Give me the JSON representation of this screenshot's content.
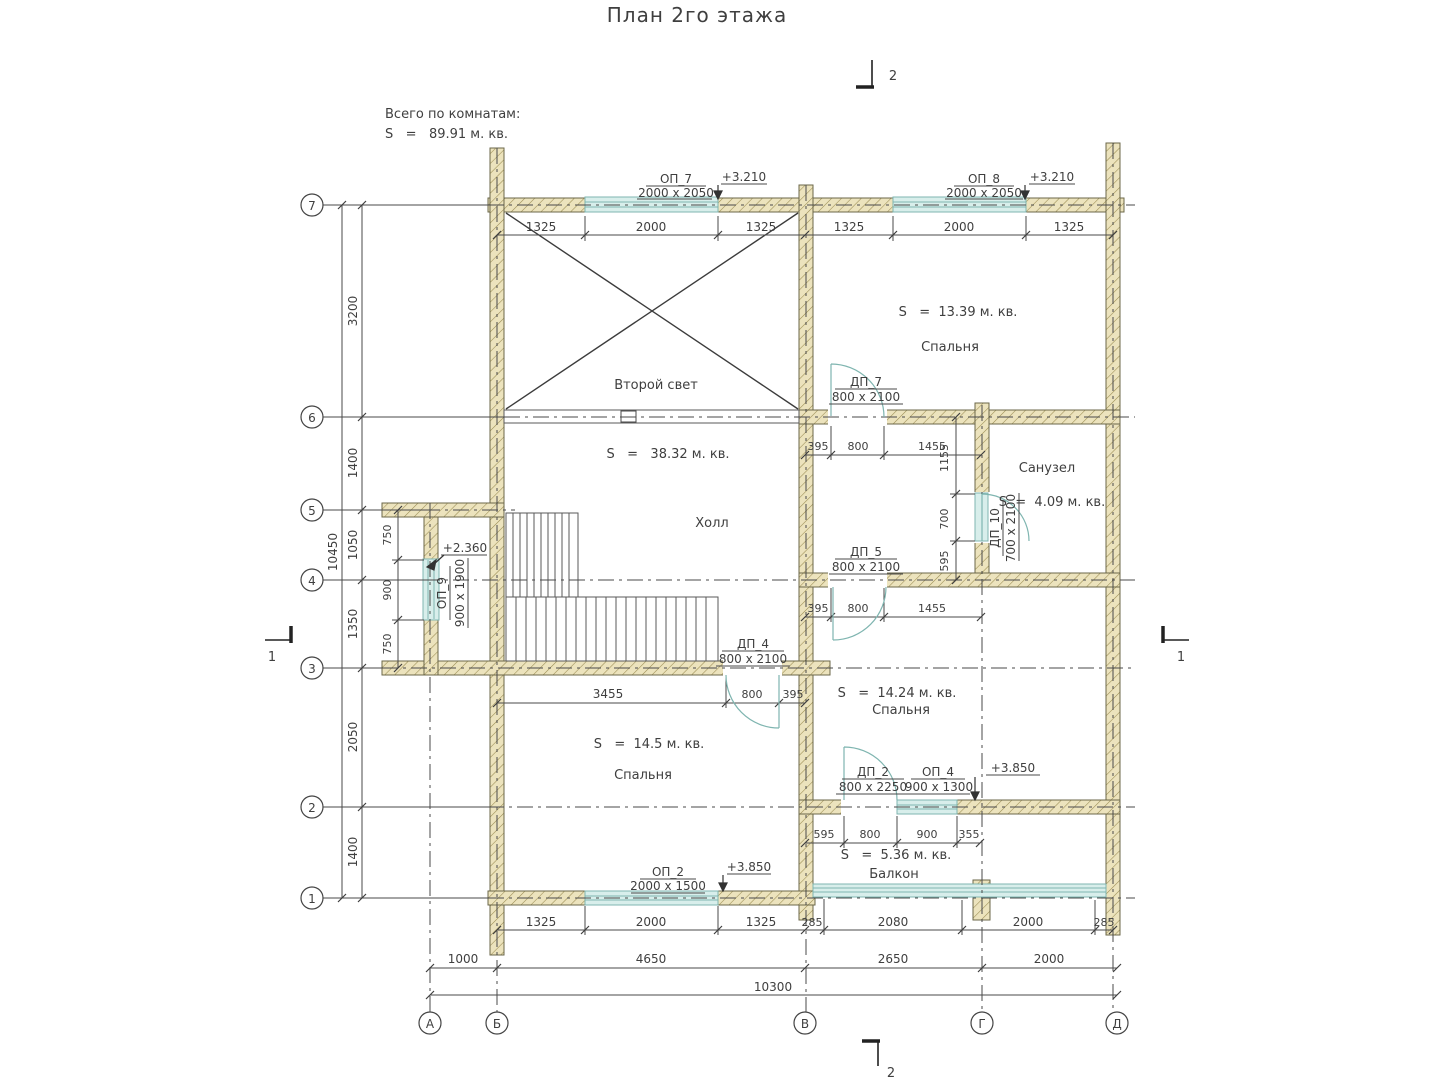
{
  "title": "План 2го этажа",
  "note": {
    "line1": "Всего по комнатам:",
    "line2": "S   =   89.91 м. кв."
  },
  "rooms": {
    "second_light": {
      "name": "Второй свет"
    },
    "hall": {
      "name": "Холл",
      "area": "S   =   38.32 м. кв."
    },
    "bedroom_top": {
      "name": "Спальня",
      "area": "S   =  13.39 м. кв."
    },
    "bathroom": {
      "name": "Санузел",
      "area": "S  =  4.09 м. кв."
    },
    "bedroom_mid": {
      "name": "Спальня",
      "area": "S   =  14.24 м. кв."
    },
    "bedroom_bottom": {
      "name": "Спальня",
      "area": "S   =  14.5 м. кв."
    },
    "balcony": {
      "name": "Балкон",
      "area": "S   =  5.36 м. кв."
    }
  },
  "openings": {
    "op7": {
      "label": "ОП_7",
      "size": "2000 x 2050",
      "elevation": "+3.210"
    },
    "op8": {
      "label": "ОП_8",
      "size": "2000 x 2050",
      "elevation": "+3.210"
    },
    "op2": {
      "label": "ОП_2",
      "size": "2000 x 1500",
      "elevation": "+3.850"
    },
    "op4": {
      "label": "ОП_4",
      "size": "900 x 1300"
    },
    "op9": {
      "label": "ОП_9",
      "size": "900 x 1900",
      "elevation": "+2.360"
    },
    "dp7": {
      "label": "ДП_7",
      "size": "800 x 2100"
    },
    "dp5": {
      "label": "ДП_5",
      "size": "800 x 2100"
    },
    "dp4": {
      "label": "ДП_4",
      "size": "800 x 2100"
    },
    "dp2": {
      "label": "ДП_2",
      "size": "800 x 2250"
    },
    "dp10": {
      "label": "ДП_10",
      "size": "700 x 2100"
    },
    "balcony_elevation": "+3.850"
  },
  "axes": {
    "rows": [
      "7",
      "6",
      "5",
      "4",
      "3",
      "2",
      "1"
    ],
    "cols": [
      "А",
      "Б",
      "В",
      "Г",
      "Д"
    ]
  },
  "sections": {
    "top": "2",
    "bottom": "2",
    "left": "1",
    "right": "1"
  },
  "dims": {
    "top": [
      "1325",
      "2000",
      "1325",
      "1325",
      "2000",
      "1325"
    ],
    "left": [
      "3200",
      "1400",
      "1050",
      "1350",
      "2050",
      "1400"
    ],
    "left_total": "10450",
    "bay": [
      "750",
      "900",
      "750"
    ],
    "dp7_chain": [
      "395",
      "800",
      "1455"
    ],
    "bath_chain": [
      "1155",
      "700",
      "595"
    ],
    "dp5_chain": [
      "395",
      "800",
      "1455"
    ],
    "dp4_chain": [
      "3455",
      "800",
      "395"
    ],
    "dp2_chain": [
      "595",
      "800",
      "900",
      "355"
    ],
    "bottom": [
      "1325",
      "2000",
      "1325",
      "285",
      "2080",
      "2000",
      "285"
    ],
    "lower": [
      "1000",
      "4650",
      "2650",
      "2000"
    ],
    "lower_total": "10300"
  },
  "colors": {
    "wall_fill": "#ece3bd",
    "wall_hatch": "#9a8c52",
    "glass": "#d8eeeb",
    "glass_stroke": "#7fb5b0",
    "line": "#3f3f3f"
  }
}
